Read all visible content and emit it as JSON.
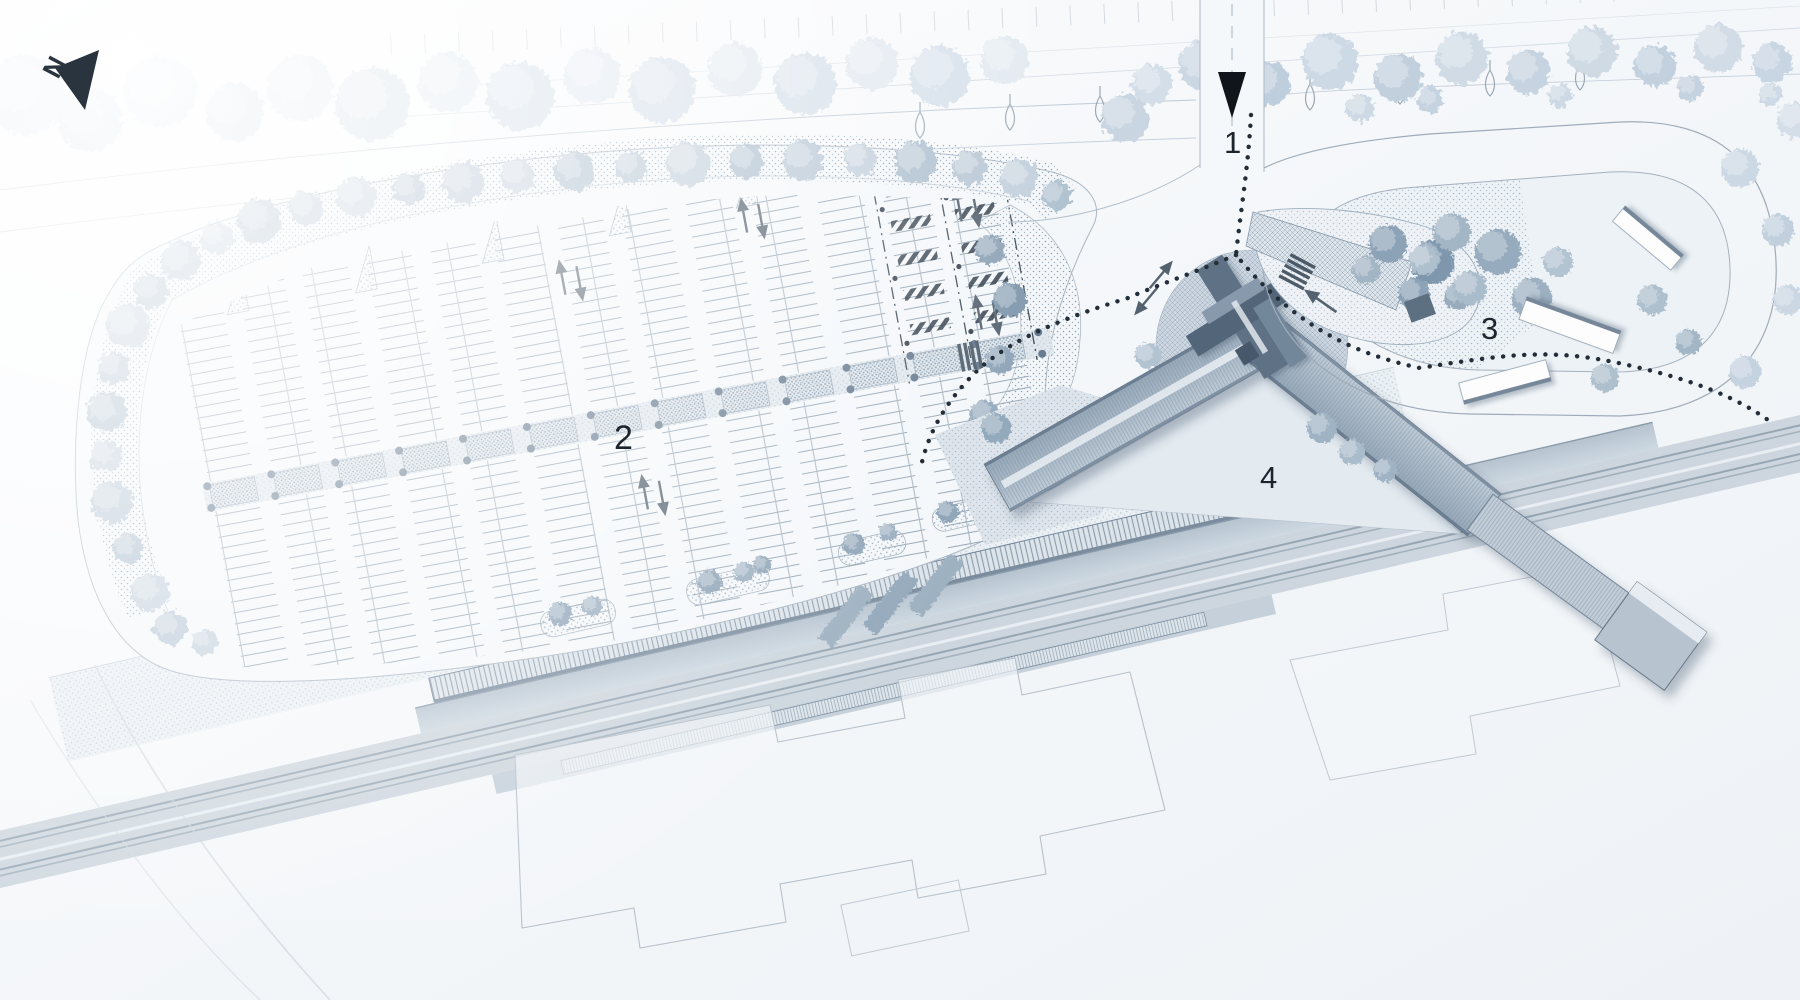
{
  "site_plan": {
    "type": "architectural-site-plan",
    "north_indicator": {
      "label": "N",
      "icon": "north-arrow-icon"
    },
    "markers": [
      {
        "label": "1",
        "icon": "entrance-triangle-icon"
      },
      {
        "label": "2"
      },
      {
        "label": "3"
      },
      {
        "label": "4"
      }
    ],
    "icons": {
      "accessible_stalls": "wheelchair-icon",
      "flow_arrows": "arrow-up-down-icon",
      "street_lamps": "lamp-icon"
    },
    "colors": {
      "marker_text": "#1c242e",
      "north_arrow": "#29343f",
      "dotted_path": "#232e39",
      "roof": "#a9b7c5",
      "tower": "#5d7184",
      "plaza": "#ccd6e0",
      "tree_light": "#dde6ee",
      "tree_dark": "#8ca2b6",
      "rail_bed": "#cdd6de"
    }
  }
}
